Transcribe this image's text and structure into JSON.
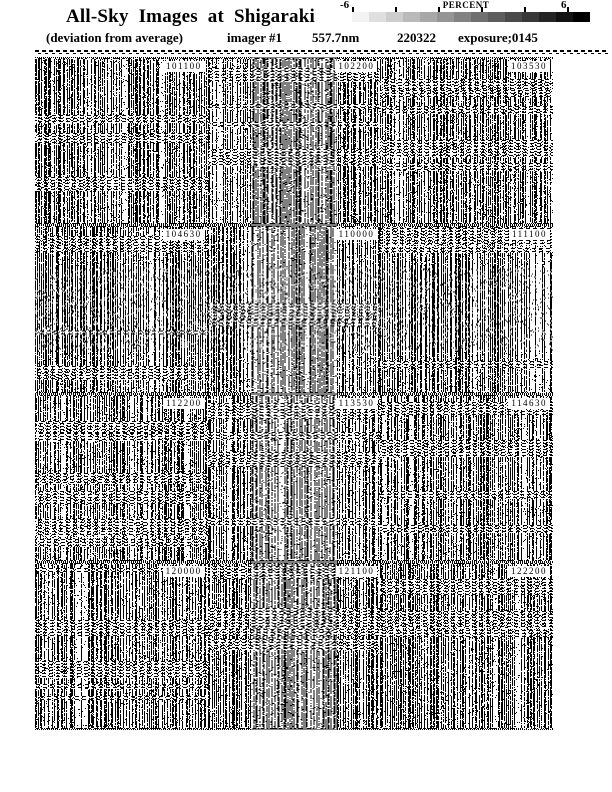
{
  "header": {
    "title": "All-Sky Images at Shigaraki",
    "subtitle": "(deviation from average)",
    "imager_label": "imager #1",
    "wavelength": "557.7nm",
    "date": "220322",
    "exposure": "exposure;0145"
  },
  "colorbar": {
    "label": "PERCENT",
    "min_label": "-6",
    "max_label": "6",
    "steps": 14,
    "tick_count": 6,
    "start_color": "#f2f2f2",
    "end_color": "#000000"
  },
  "grid": {
    "rows": 4,
    "cols": 3,
    "cells": [
      {
        "time": "101100"
      },
      {
        "time": "102200"
      },
      {
        "time": "103530"
      },
      {
        "time": "104630"
      },
      {
        "time": "110000"
      },
      {
        "time": "111100"
      },
      {
        "time": "112200"
      },
      {
        "time": "113530"
      },
      {
        "time": "114630"
      },
      {
        "time": "120000"
      },
      {
        "time": "121100"
      },
      {
        "time": "122200"
      }
    ]
  },
  "chart_data": {
    "type": "heatmap",
    "title": "All-Sky Images at Shigaraki",
    "subtitle": "(deviation from average)",
    "instrument": "imager #1",
    "wavelength": "557.7nm",
    "date": "220322",
    "exposure": "0145",
    "panel_grid": {
      "rows": 4,
      "cols": 3
    },
    "panels": [
      "101100",
      "102200",
      "103530",
      "104630",
      "110000",
      "111100",
      "112200",
      "113530",
      "114630",
      "120000",
      "121100",
      "122200"
    ],
    "colorbar": {
      "label": "PERCENT",
      "min": -6,
      "max": 6,
      "style": "stepped-grayscale-light-to-dark"
    },
    "notes": "Each panel is a halftone-dithered all-sky image; values shown as percent deviation from average."
  }
}
